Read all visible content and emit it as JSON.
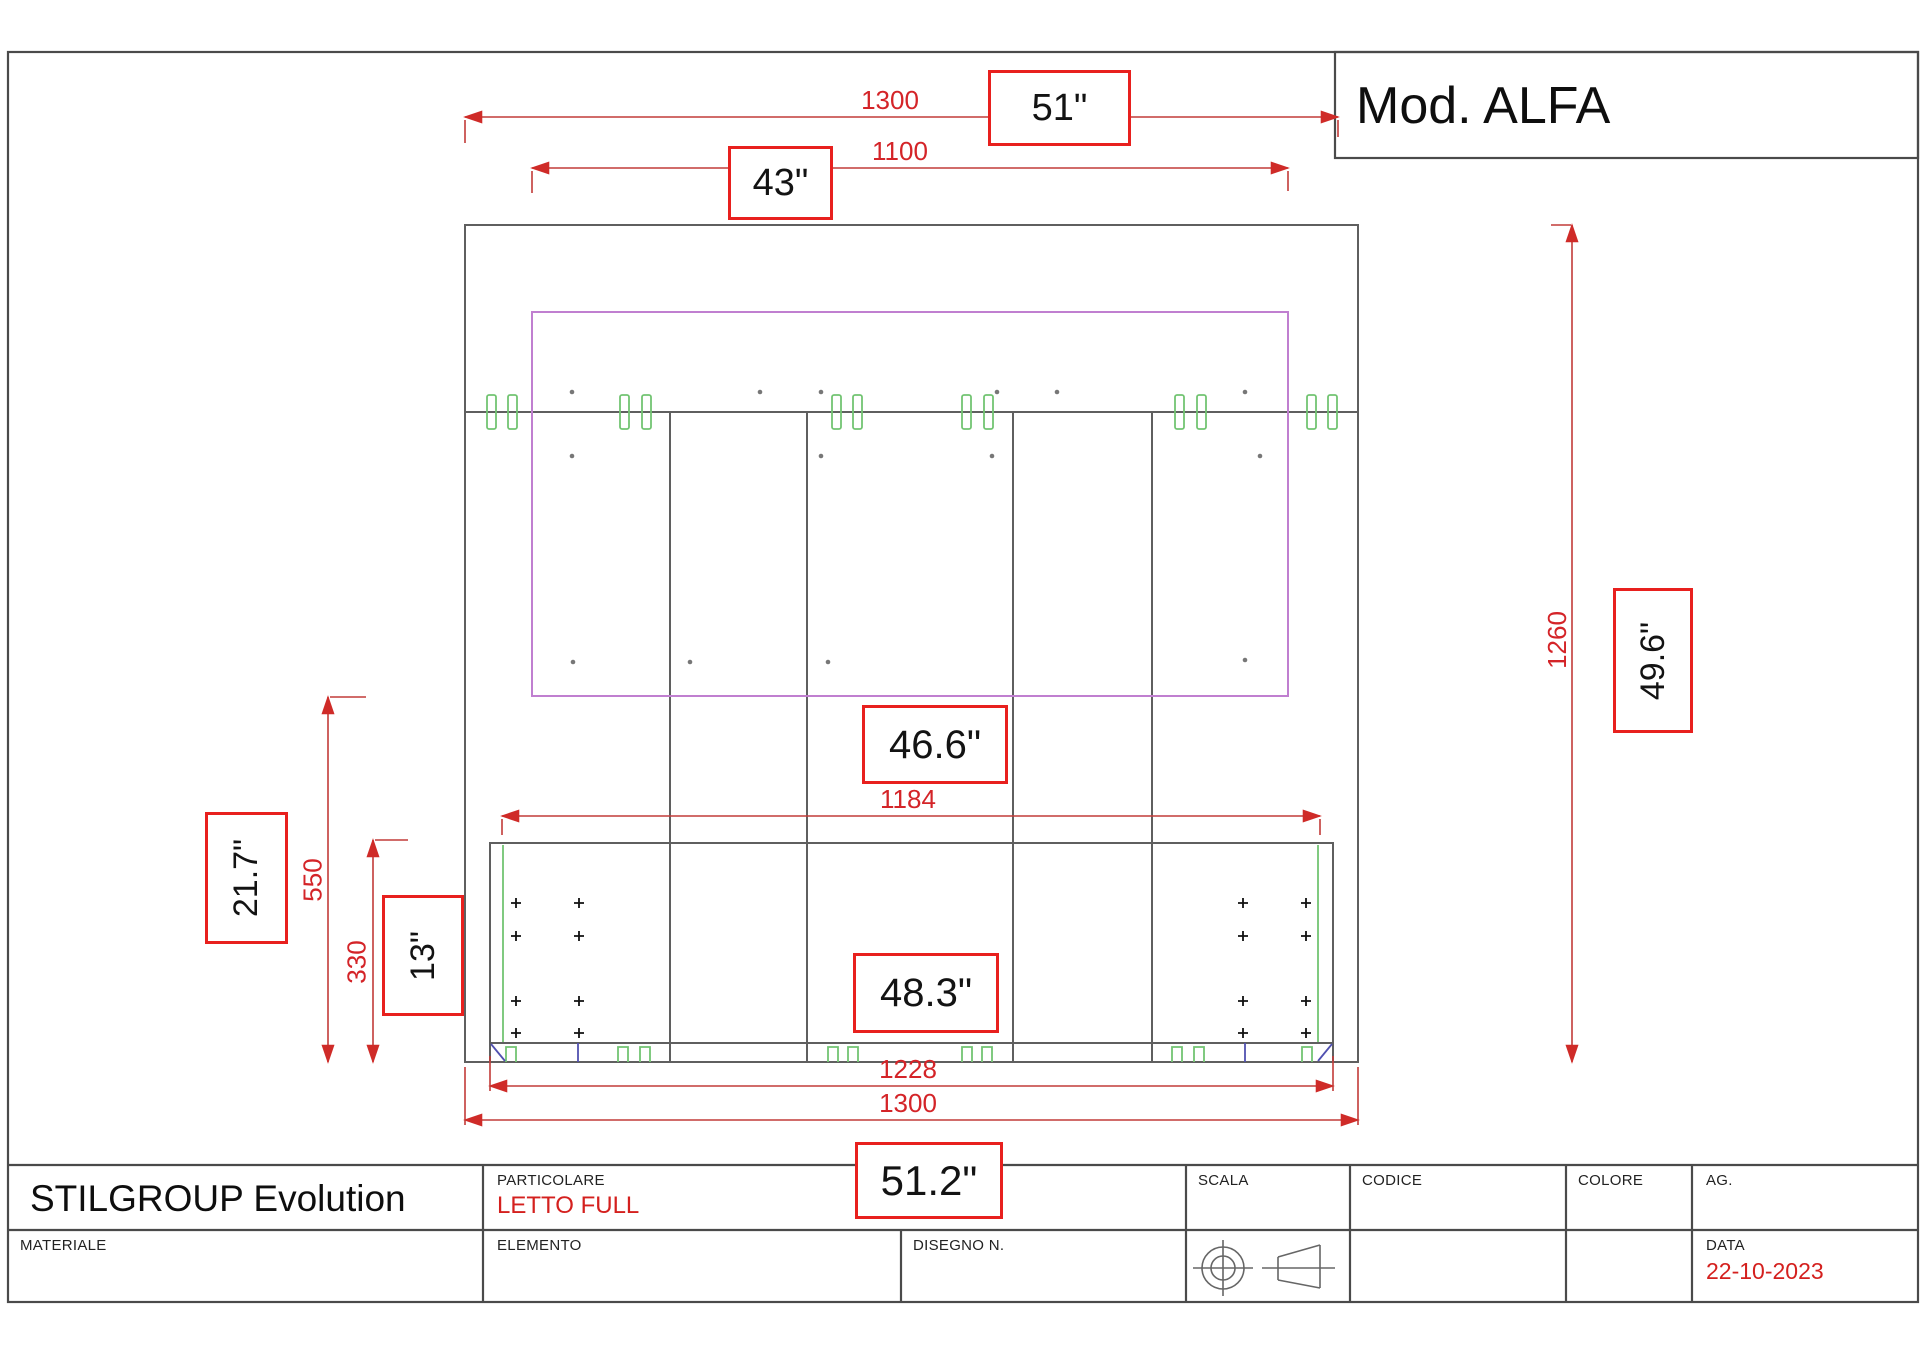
{
  "sheet": {
    "model": "Mod. ALFA"
  },
  "annotations": {
    "top_width_mm": "1300",
    "top_width_in": "51\"",
    "headboard_width_mm": "1100",
    "headboard_width_in": "43\"",
    "height_mm": "1260",
    "height_in": "49.6\"",
    "footboard_height_mm": "550",
    "footboard_height_in": "21.7\"",
    "leg_height_mm": "330",
    "leg_height_in": "13\"",
    "slat_width_mm": "1184",
    "slat_width_in": "46.6\"",
    "base_width_mm": "1228",
    "base_width_in": "48.3\"",
    "overall_width_mm": "1300",
    "overall_width_in": "51.2\""
  },
  "title_block": {
    "company": "STILGROUP Evolution",
    "particolare_label": "PARTICOLARE",
    "particolare_value": "LETTO FULL",
    "materiale_label": "MATERIALE",
    "elemento_label": "ELEMENTO",
    "disegno_label": "DISEGNO N.",
    "scala_label": "SCALA",
    "codice_label": "CODICE",
    "colore_label": "COLORE",
    "ag_label": "AG.",
    "data_label": "DATA",
    "data_value": "22-10-2023"
  },
  "colors": {
    "dimension_red": "#d42428",
    "annotation_box_red": "#e8201e",
    "structure_gray": "#5f5f5f",
    "panel_purple": "#c07fd0",
    "hardware_green": "#72c472",
    "hardware_blue": "#5050b0"
  }
}
